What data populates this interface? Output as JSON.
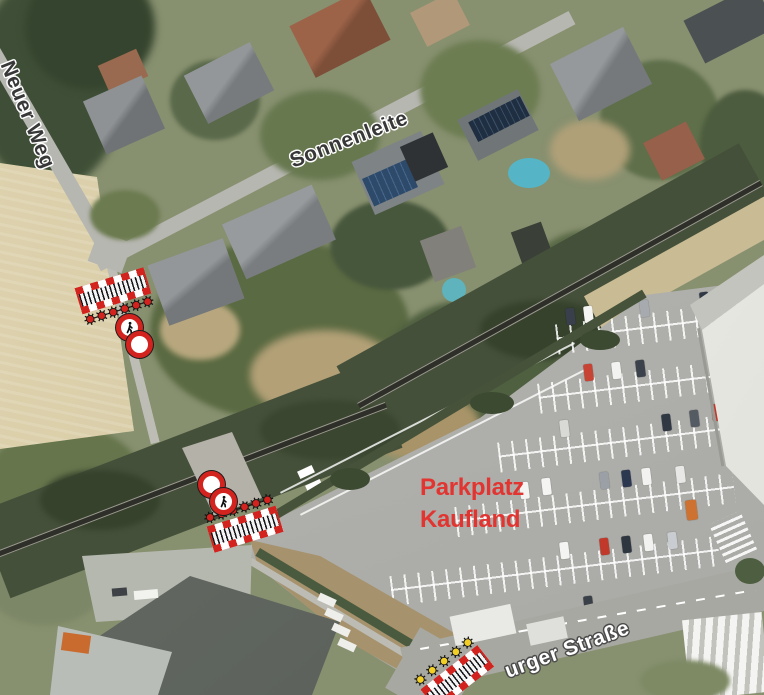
{
  "image_type": "annotated aerial map / traffic-control plan over satellite photo",
  "labels": {
    "street_neuer_weg": "Neuer Weg",
    "street_sonnenleite": "Sonnenleite",
    "street_burger_strasse": "urger Straße",
    "parkplatz_line1": "Parkplatz",
    "parkplatz_line2": "Kaufland"
  },
  "annotation_colors": {
    "highlight_red": "#e23531",
    "barrier_red": "#d2231e",
    "lamp_red": "#d2231e",
    "lamp_yellow": "#f2cf26",
    "sign_border_red": "#d2231e",
    "street_label_dark": "#383838",
    "street_label_light": "#ffffff"
  },
  "markers": {
    "barriers": [
      {
        "id": "barrier-north",
        "lamp_color": "red",
        "lamp_count": 6,
        "lamps_side": "bottom"
      },
      {
        "id": "barrier-rail-crossing",
        "lamp_color": "red",
        "lamp_count": 6,
        "lamps_side": "top"
      },
      {
        "id": "barrier-south",
        "lamp_color": "yellow",
        "lamp_count": 5,
        "lamps_side": "top"
      }
    ],
    "signs": [
      {
        "id": "no-pedestrians-sign-north",
        "type": "no-pedestrians"
      },
      {
        "id": "no-vehicles-sign-north",
        "type": "no-vehicles"
      },
      {
        "id": "no-vehicles-sign-crossing",
        "type": "no-vehicles"
      },
      {
        "id": "no-pedestrians-sign-crossing",
        "type": "no-pedestrians"
      }
    ]
  }
}
